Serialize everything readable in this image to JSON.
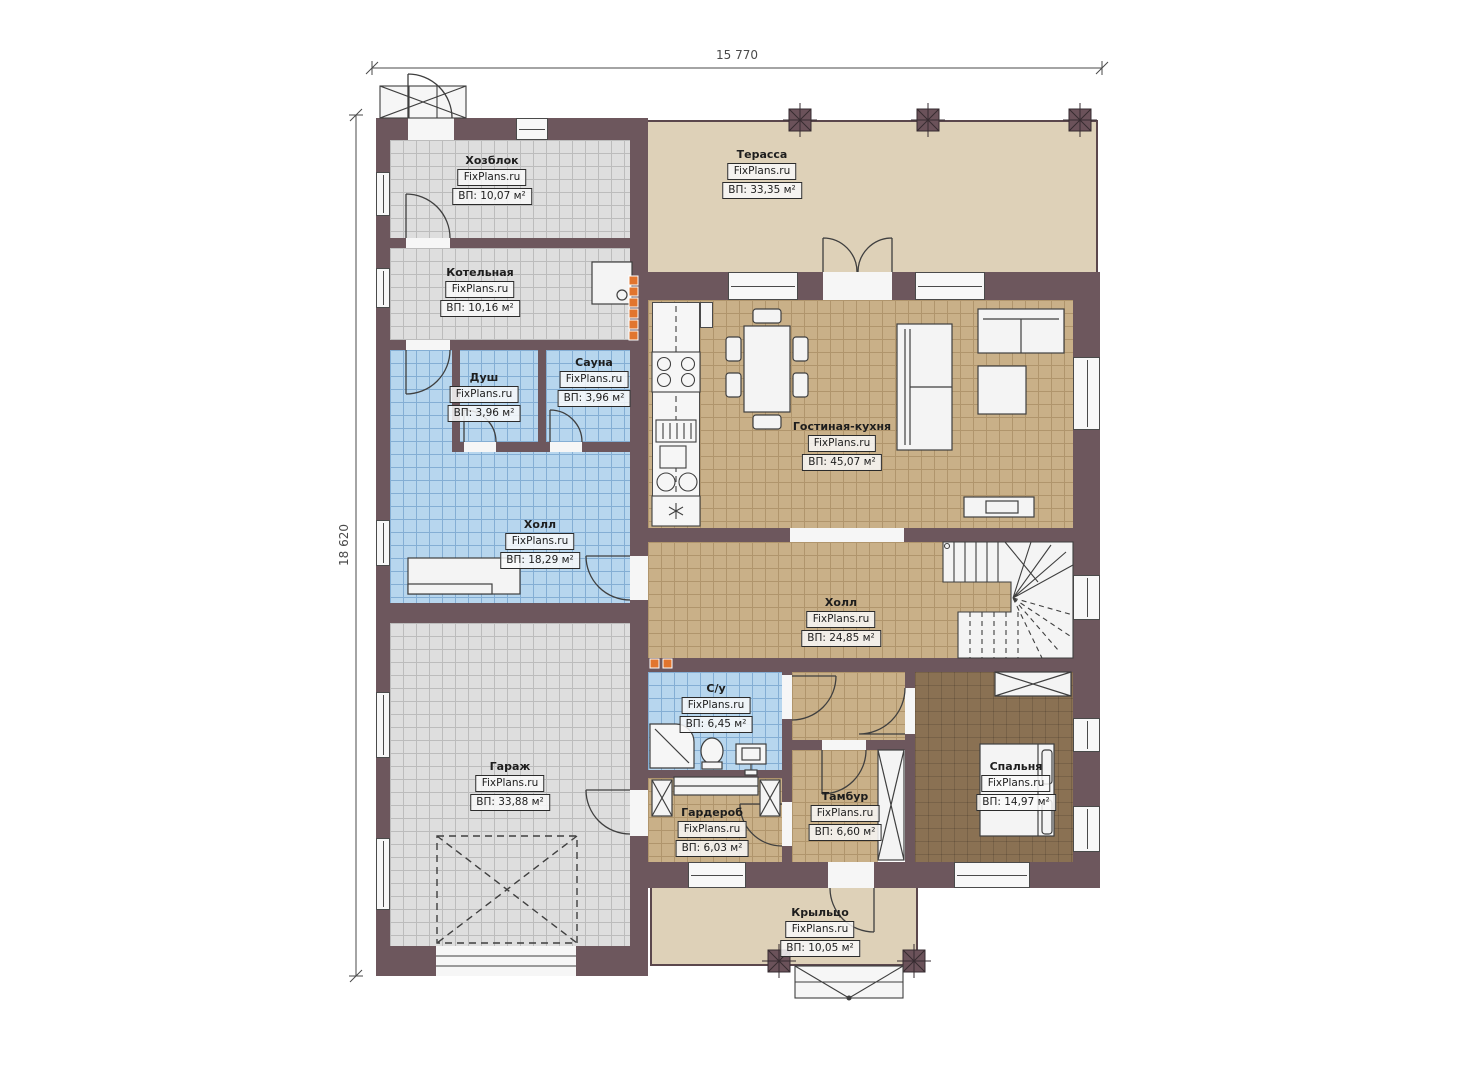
{
  "watermark": "FixPlans.ru",
  "dimensions": {
    "width": "15 770",
    "height": "18 620"
  },
  "rooms": [
    {
      "key": "hozblok",
      "name": "Хозблок",
      "area": "ВП: 10,07 м²"
    },
    {
      "key": "kotelnaya",
      "name": "Котельная",
      "area": "ВП: 10,16 м²"
    },
    {
      "key": "dush",
      "name": "Душ",
      "area": "ВП: 3,96 м²"
    },
    {
      "key": "sauna",
      "name": "Сауна",
      "area": "ВП: 3,96 м²"
    },
    {
      "key": "holl-1",
      "name": "Холл",
      "area": "ВП: 18,29 м²"
    },
    {
      "key": "terassa",
      "name": "Терасса",
      "area": "ВП: 33,35 м²"
    },
    {
      "key": "gostinaya-kuhnya",
      "name": "Гостиная-кухня",
      "area": "ВП: 45,07 м²"
    },
    {
      "key": "holl-2",
      "name": "Холл",
      "area": "ВП: 24,85 м²"
    },
    {
      "key": "su",
      "name": "С/у",
      "area": "ВП: 6,45 м²"
    },
    {
      "key": "garazh",
      "name": "Гараж",
      "area": "ВП: 33,88 м²"
    },
    {
      "key": "garderob",
      "name": "Гардероб",
      "area": "ВП: 6,03 м²"
    },
    {
      "key": "tambur",
      "name": "Тамбур",
      "area": "ВП: 6,60 м²"
    },
    {
      "key": "spalnya",
      "name": "Спальня",
      "area": "ВП: 14,97 м²"
    },
    {
      "key": "krylco",
      "name": "Крыльцо",
      "area": "ВП: 10,05 м²"
    }
  ],
  "colors": {
    "wall": "#6d575d",
    "floor_gray": "#dedede",
    "floor_blue": "#b7d6ee",
    "floor_tan": "#c9b088",
    "floor_brown": "#8a7153",
    "floor_beige": "#ded1b8",
    "vent_marker_orange": "#e2752e"
  }
}
